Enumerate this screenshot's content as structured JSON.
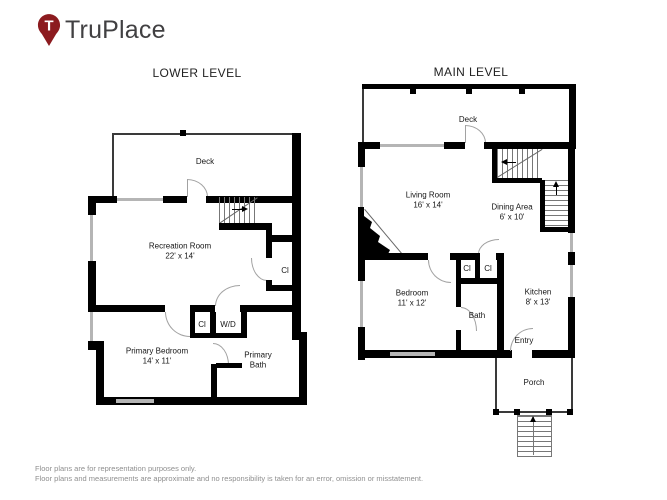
{
  "brand": {
    "name": "TruPlace",
    "pin_letter": "T"
  },
  "colors": {
    "wall": "#000000",
    "window": "#b5b5b5",
    "brand_pin": "#8c1b1f",
    "brand_text": "#414042",
    "footer_text": "#8f8f8f"
  },
  "lower": {
    "title": "LOWER LEVEL",
    "deck_label": "Deck",
    "recreation_room": {
      "name": "Recreation Room",
      "dims": "22' x 14'"
    },
    "closet_right_label": "Cl",
    "closet_hall_label": "Cl",
    "washer_dryer_label": "W/D",
    "primary_bedroom": {
      "name": "Primary Bedroom",
      "dims": "14' x 11'"
    },
    "primary_bath": {
      "line1": "Primary",
      "line2": "Bath"
    }
  },
  "main": {
    "title": "MAIN LEVEL",
    "deck_label": "Deck",
    "living_room": {
      "name": "Living Room",
      "dims": "16' x 14'"
    },
    "dining_area": {
      "name": "Dining Area",
      "dims": "6' x 10'"
    },
    "closet_1_label": "Cl",
    "closet_2_label": "Cl",
    "bedroom": {
      "name": "Bedroom",
      "dims": "11' x 12'"
    },
    "bath_label": "Bath",
    "kitchen": {
      "name": "Kitchen",
      "dims": "8' x 13'"
    },
    "entry_label": "Entry",
    "porch_label": "Porch"
  },
  "footer": {
    "line1": "Floor plans are for representation purposes only.",
    "line2": "Floor plans and measurements are approximate and no responsibility is taken for an error, omission or misstatement."
  }
}
